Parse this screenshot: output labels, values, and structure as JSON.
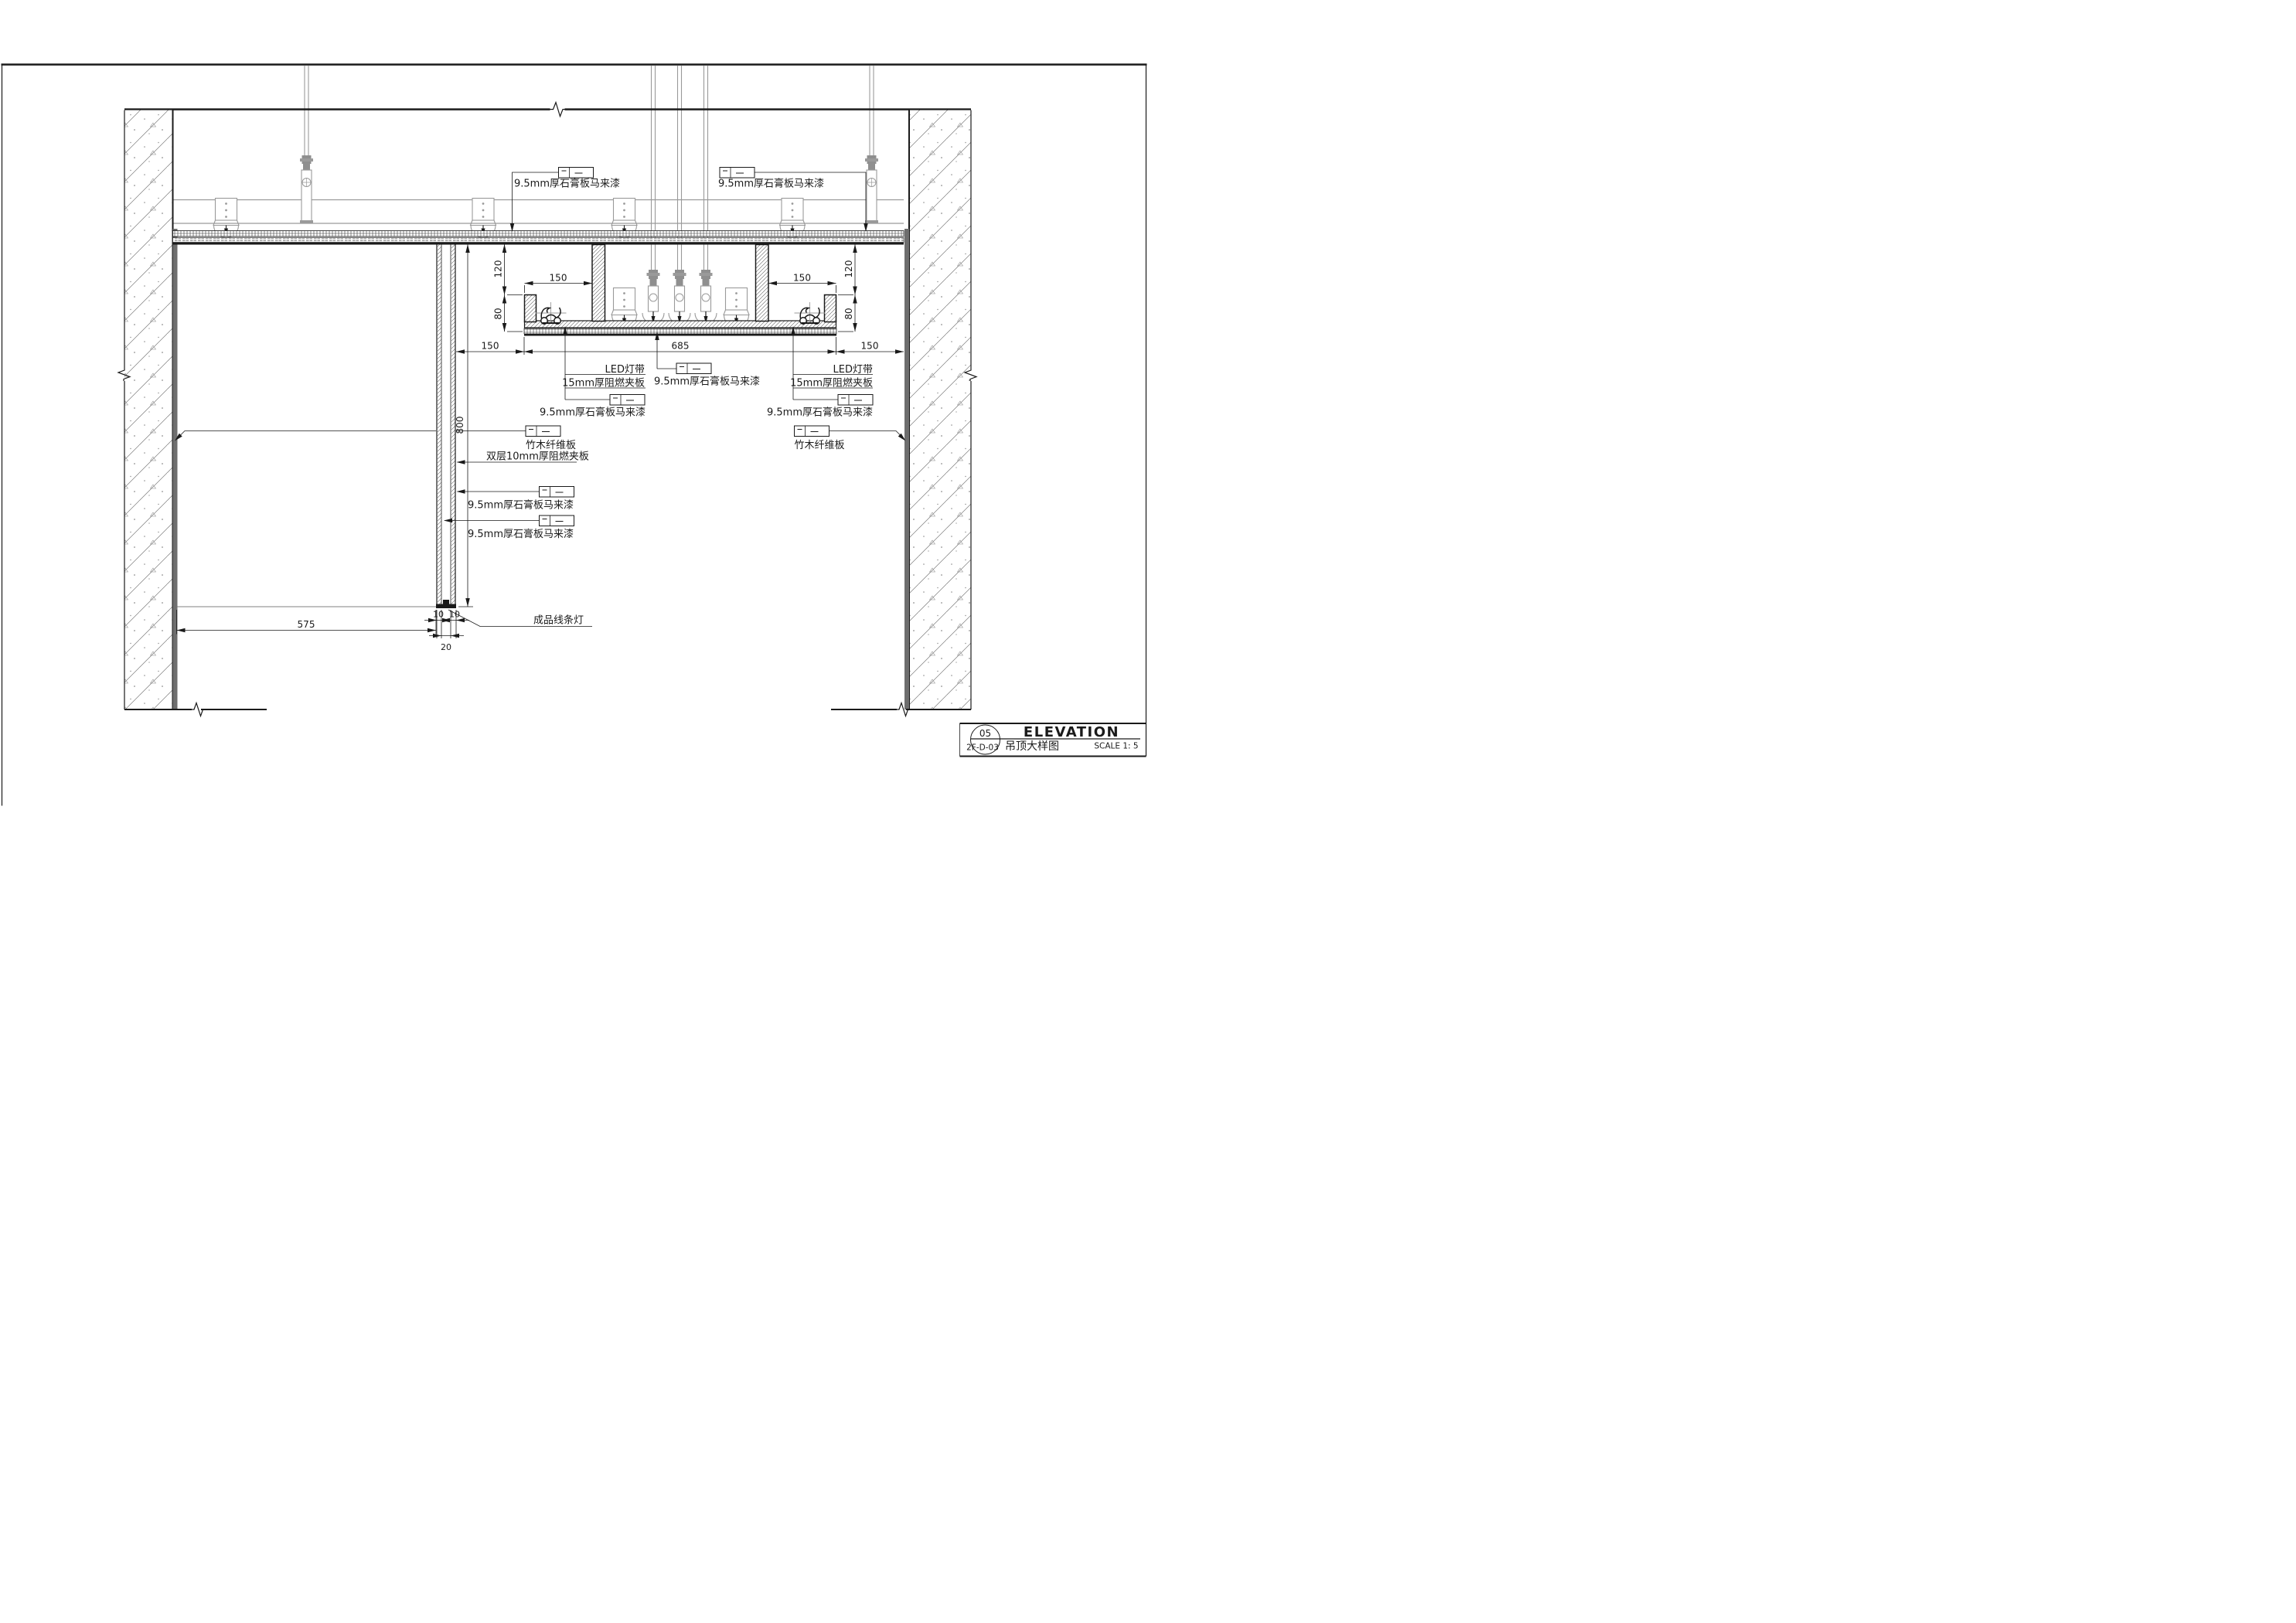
{
  "page": {
    "background": "#ffffff",
    "line_color": "#1a1a1a",
    "structure_gray": "#9a9a9a",
    "finish_strip_color": "#6e6e6e"
  },
  "annotations": {
    "gypsum_board": "9.5mm厚石膏板马来漆",
    "led_strip": "LED灯带",
    "plywood_15mm": "15mm厚阻燃夹板",
    "bamboo_fiber_panel": "竹木纤维板",
    "double_plywood_10mm": "双层10mm厚阻燃夹板",
    "finished_linear_light": "成品线条灯"
  },
  "dimensions": {
    "d120": "120",
    "d150": "150",
    "d80": "80",
    "d685": "685",
    "d800": "800",
    "d575": "575",
    "d10": "10",
    "d20": "20"
  },
  "title_block": {
    "detail_number": "05",
    "drawing_number": "2F-D-03",
    "drawing_title_cn": "吊顶大样图",
    "drawing_title_en": "ELEVATION",
    "scale_label": "SCALE 1: 5"
  }
}
